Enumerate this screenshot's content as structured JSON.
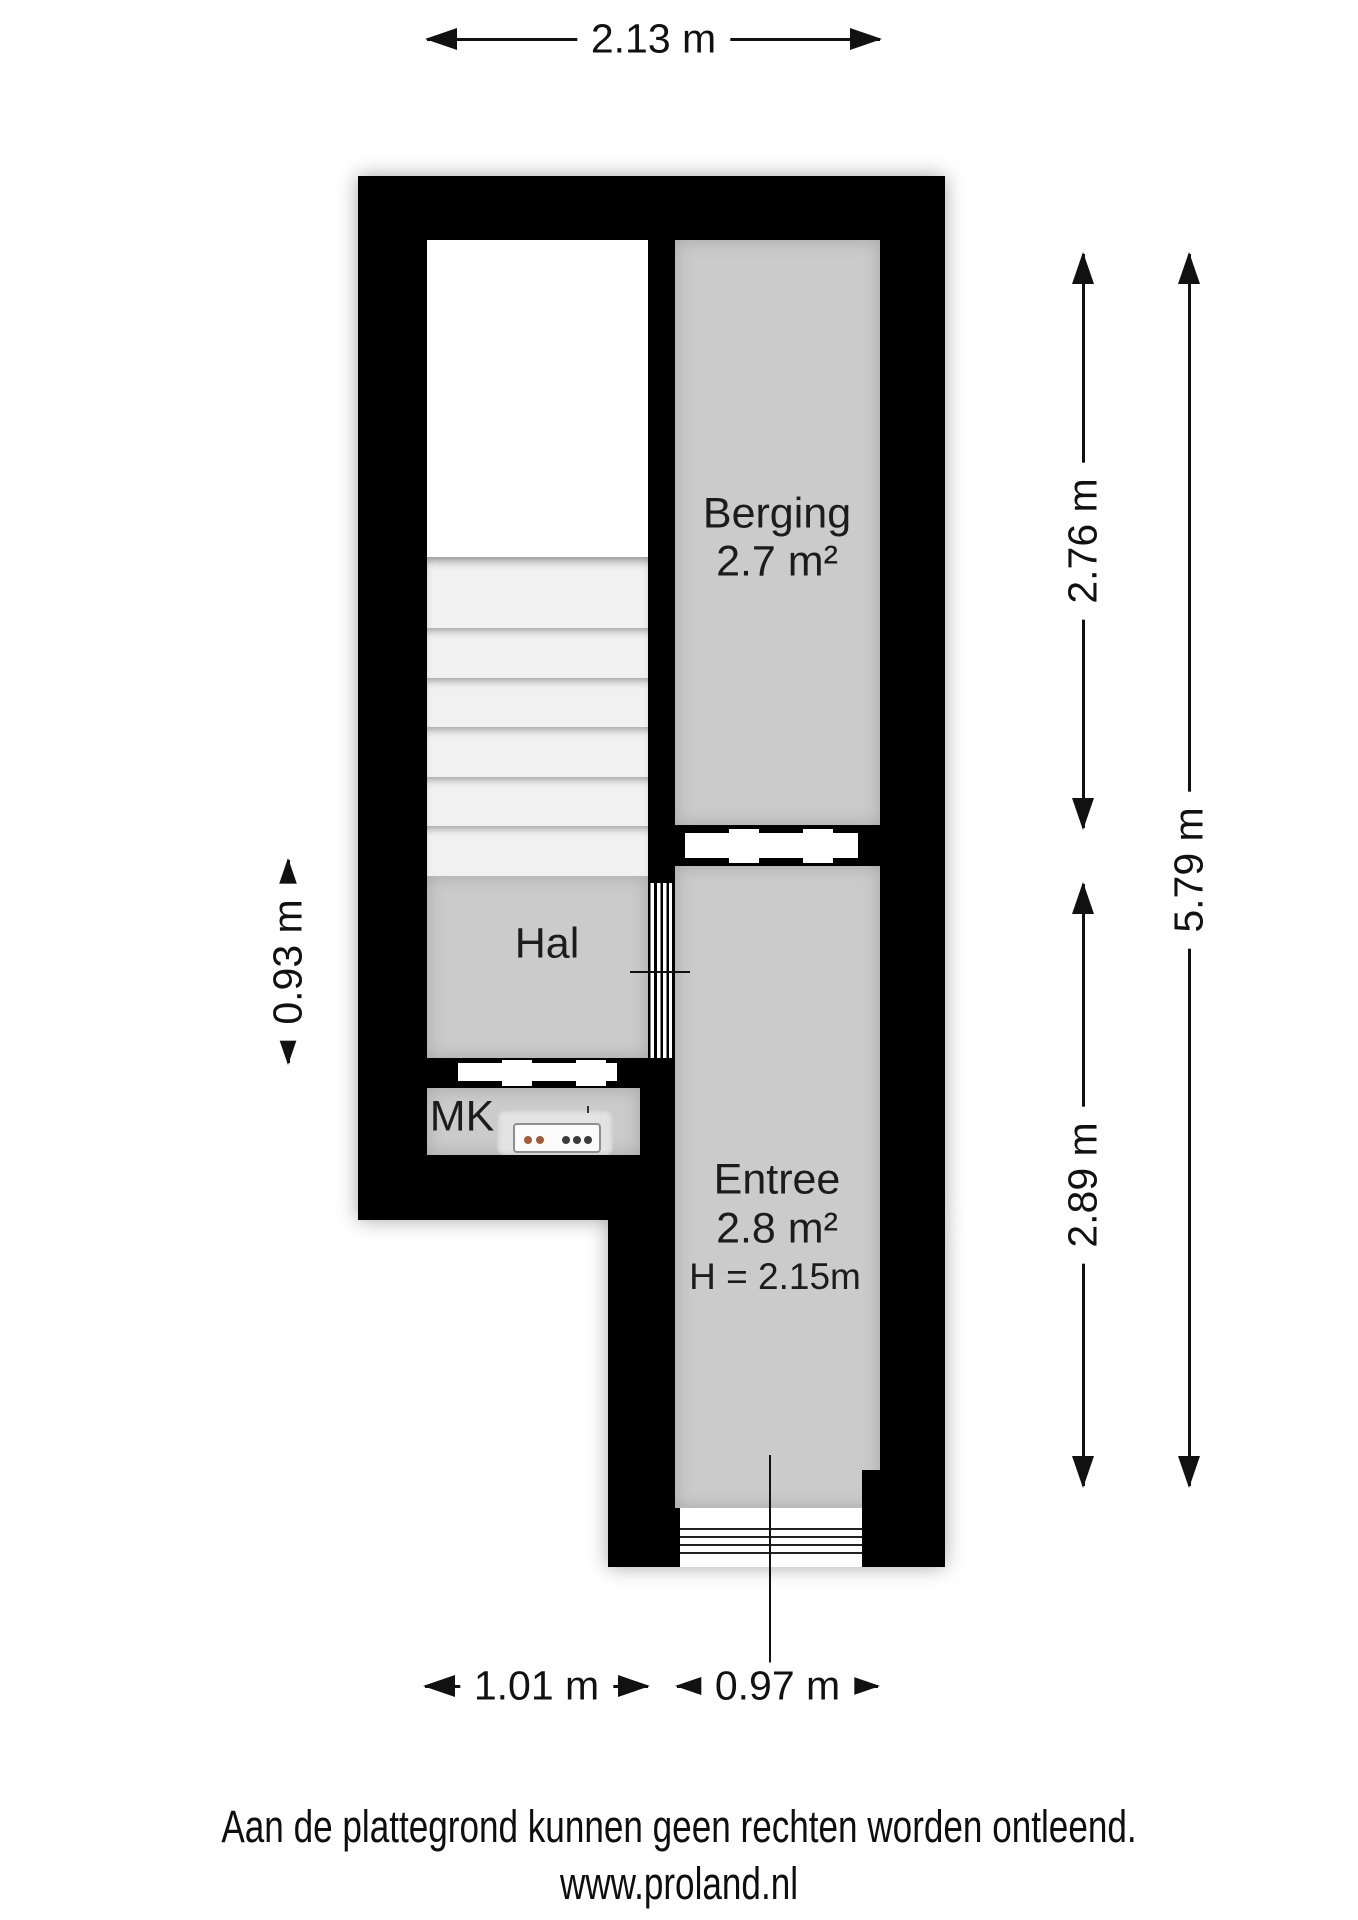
{
  "dimensions": {
    "top": "2.13 m",
    "left": "0.93 m",
    "right_upper": "2.76 m",
    "right_lower": "2.89 m",
    "right_total": "5.79 m",
    "bottom_left": "1.01 m",
    "bottom_right": "0.97 m"
  },
  "rooms": {
    "berging": {
      "name": "Berging",
      "area": "2.7 m²"
    },
    "hal": {
      "name": "Hal"
    },
    "mk": {
      "name": "MK"
    },
    "entree": {
      "name": "Entree",
      "area": "2.8 m²",
      "ceiling_height": "H = 2.15m"
    }
  },
  "footer": {
    "disclaimer": "Aan de plattegrond kunnen geen rechten worden ontleend.",
    "website": "www.proland.nl"
  },
  "colors": {
    "wall": "#000000",
    "room_fill": "#cbcbcb",
    "stair_fill": "#f1f1f1",
    "background": "#ffffff"
  }
}
